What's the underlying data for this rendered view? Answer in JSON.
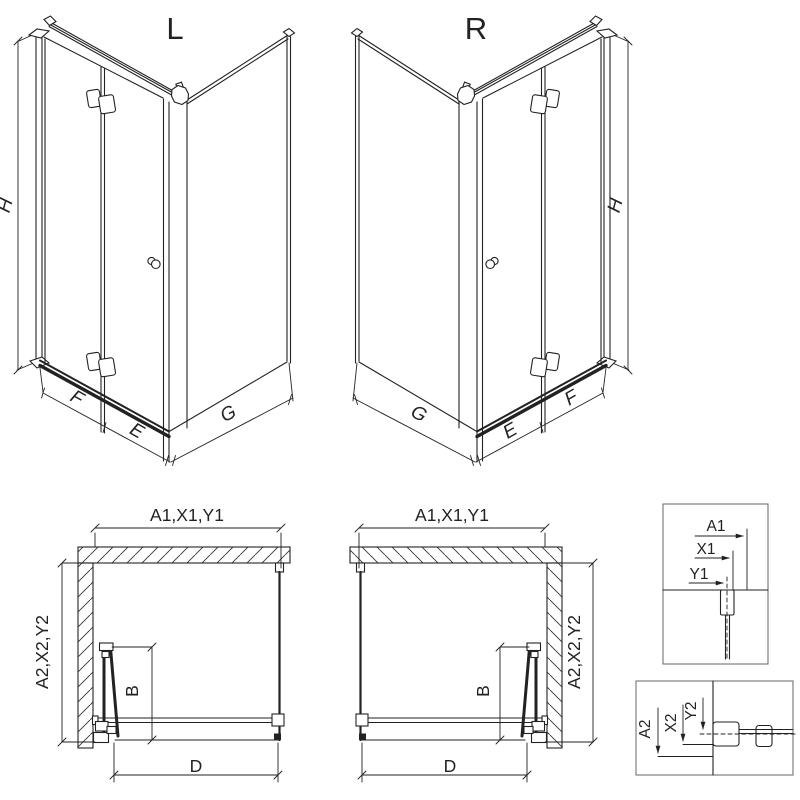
{
  "drawing": {
    "background": "#ffffff",
    "line_color": "#222222",
    "left_variant": {
      "title": "L"
    },
    "right_variant": {
      "title": "R"
    },
    "iso_dim_labels": {
      "height": "H",
      "near_wall_panel": "F",
      "door_panel": "E",
      "side_panel": "G"
    },
    "plan_dim_labels": {
      "width": "A1,X1,Y1",
      "depth": "A2,X2,Y2",
      "door_fold": "B",
      "entry": "D"
    },
    "width_detail": {
      "a1": "A1",
      "x1": "X1",
      "y1": "Y1"
    },
    "depth_detail": {
      "a2": "A2",
      "x2": "X2",
      "y2": "Y2"
    }
  }
}
